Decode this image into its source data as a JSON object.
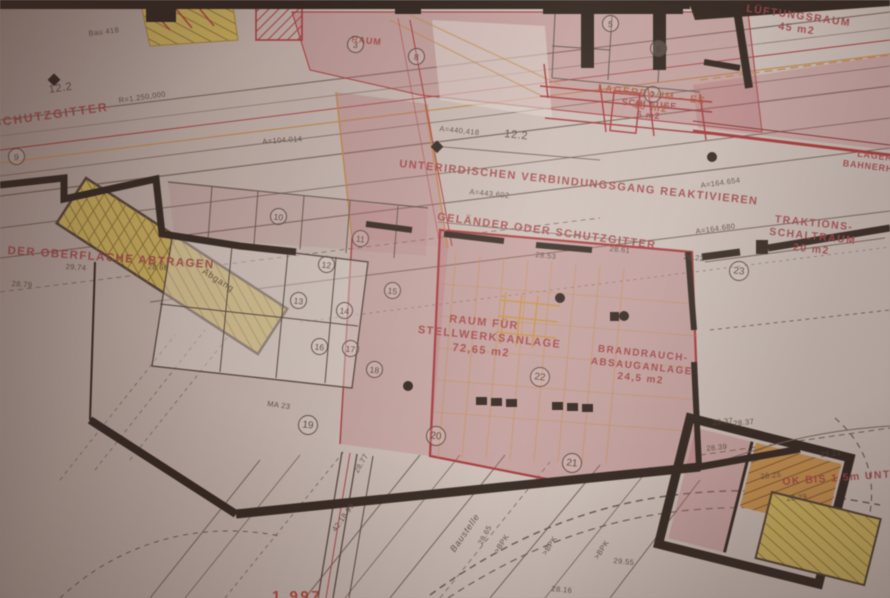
{
  "annotations": {
    "schutzgitter": "SCHUTZGITTER",
    "verbindungsgang": "UNTERIRDISCHEN VERBINDUNGSGANG REAKTIVIEREN",
    "gelaender": "GELÄNDER ODER SCHUTZGITTER",
    "oberflaeche": "DER OBERFLÄCHE ABTRAGEN",
    "stellwerk": [
      "RAUM FÜR",
      "STELLWERKSANLAGE",
      "72,65 m2"
    ],
    "brandrauch": [
      "BRANDRAUCH-",
      "ABSAUGANLAGE",
      "24,5 m2"
    ],
    "lueftung": [
      "LÜFTUNGSRAUM",
      "45 m2"
    ],
    "traktion": [
      "TRAKTIONS-",
      "SCHALTRAUM",
      "20 m2"
    ],
    "lager_es": [
      "LAGERRAUM – ES",
      "40 m2"
    ],
    "schleuse": [
      "SCHLEUSE",
      "6 m2"
    ],
    "lager_bahn": [
      "LAGERRAUM",
      "BAHNERHALTUNG"
    ],
    "raum_top": "RAUM",
    "ok_bis": "OK BIS 1.5m UNTER",
    "abgang": "Abgang",
    "baustelle": "Baustelle",
    "stamp_fragment": "1.997"
  },
  "measurements": {
    "dim_122_left": "12.2",
    "dim_122_mid": "12.2",
    "radius": "R=1.250,000",
    "a_104": "A=104.014",
    "a_440": "A=440,418",
    "a_443": "A=443,602",
    "a_164a": "A=164.654",
    "a_164b": "A=164.680",
    "ma23": "MA 23",
    "bau418": "Bau 418",
    "note_4218": "42.18.99"
  },
  "elevations": [
    "29.74",
    "28.79",
    "28.66",
    "28.53",
    "28.77",
    "28.65",
    "29.55",
    "28.39",
    "29.37",
    "28.25",
    "28.29",
    "28.16",
    "28.37",
    "28.61",
    "28.22",
    "29.21"
  ],
  "circled_numbers": [
    "3",
    "5",
    "6",
    "7",
    "8",
    "9",
    "10",
    "11",
    "12",
    "13",
    "14",
    "15",
    "16",
    "17",
    "18",
    "19",
    "20",
    "21",
    "22",
    "23"
  ],
  "track_labels": [
    ">BPK",
    ">BPK",
    ">BPK"
  ],
  "colors": {
    "line_red": "#b02c32",
    "wall_dark": "#241b15",
    "area_pink": "#bc606a",
    "area_yellow": "#d2b851",
    "area_orange": "#c98e41",
    "line_orange": "#c8873c",
    "label_red": "#a83a3f",
    "label_dark": "#453931",
    "paper": "#cfc3bc"
  }
}
